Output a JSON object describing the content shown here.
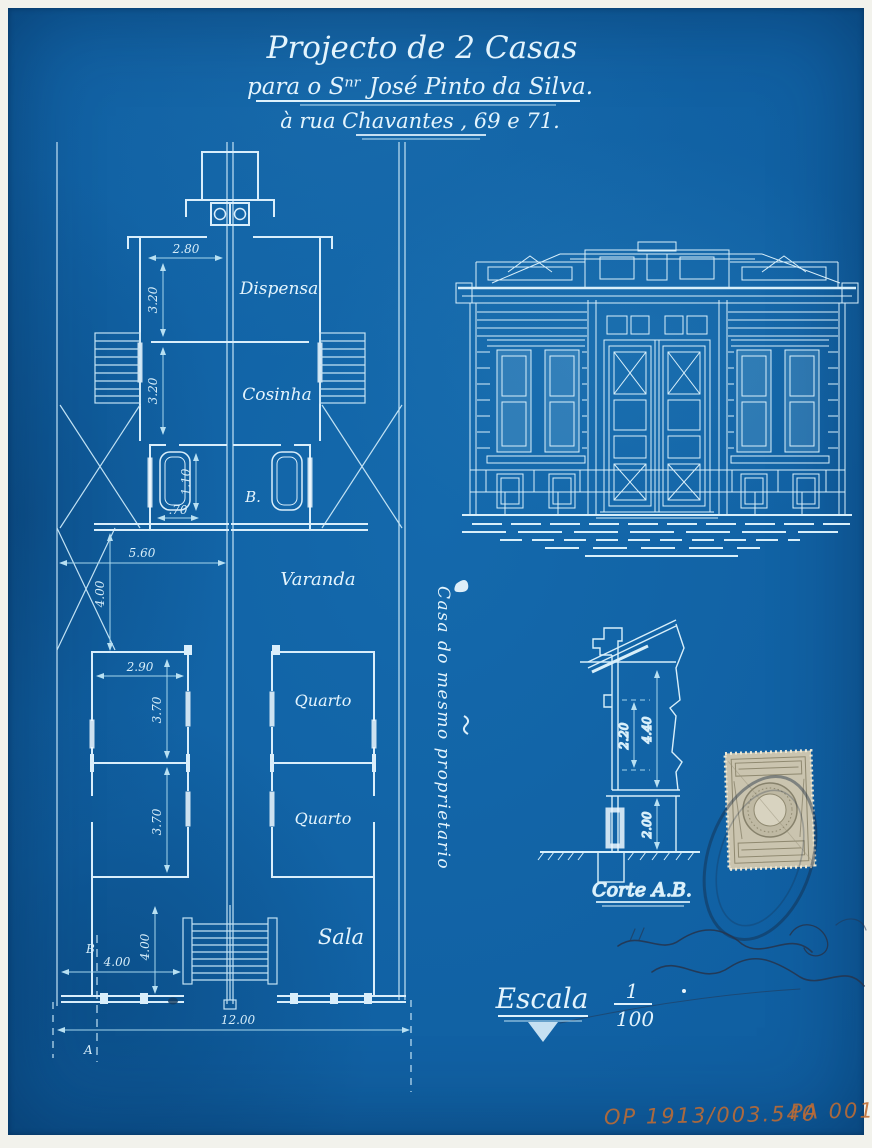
{
  "colors": {
    "paper_blue": "#1164a6",
    "line_cyan": "#d9eefb",
    "dim_cyan": "#a6d6ec",
    "text_cyan": "#e3f4fd",
    "archive_orange": "#c06c33",
    "stamp_beige": "#cac4af",
    "ink_navy": "#1b2b45",
    "border_white": "#f2f2ec"
  },
  "title": {
    "line1": "Projecto de 2 Casas",
    "line2": "para o Sⁿʳ José Pinto da Silva.",
    "line3_prefix": "à rua ",
    "line3_street": "Chavantes",
    "line3_suffix": " , 69 e 71."
  },
  "plan": {
    "labels": {
      "dispensa": "Dispensa",
      "cosinha": "Cosinha",
      "bath": "B.",
      "varanda": "Varanda",
      "quarto_1": "Quarto",
      "quarto_2": "Quarto",
      "sala": "Sala"
    },
    "side_note": "Casa do mesmo proprietario",
    "dims": {
      "rear_width": "2.80",
      "rear_depth_1": "3.20",
      "rear_depth_2": "3.20",
      "tub_len": "1.10",
      "tub_width": ".70",
      "mid_width": "5.60",
      "varanda_depth": "4.00",
      "room_width": "2.90",
      "room_depth_1": "3.70",
      "room_depth_2": "3.70",
      "front_depth": "4.00",
      "front_width": "4.00",
      "total_width": "12.00"
    },
    "markers": {
      "b": "B",
      "a": "A"
    }
  },
  "section": {
    "label": "Corte A.B.",
    "dims": {
      "window_height": "2.20",
      "ceiling_height": "4.40",
      "base_height": "2.00"
    }
  },
  "scale": {
    "word": "Escala",
    "numerator": "1",
    "denominator": "100"
  },
  "archive": {
    "code_1": "OP 1913/003.540",
    "code_2": "PA 001"
  }
}
